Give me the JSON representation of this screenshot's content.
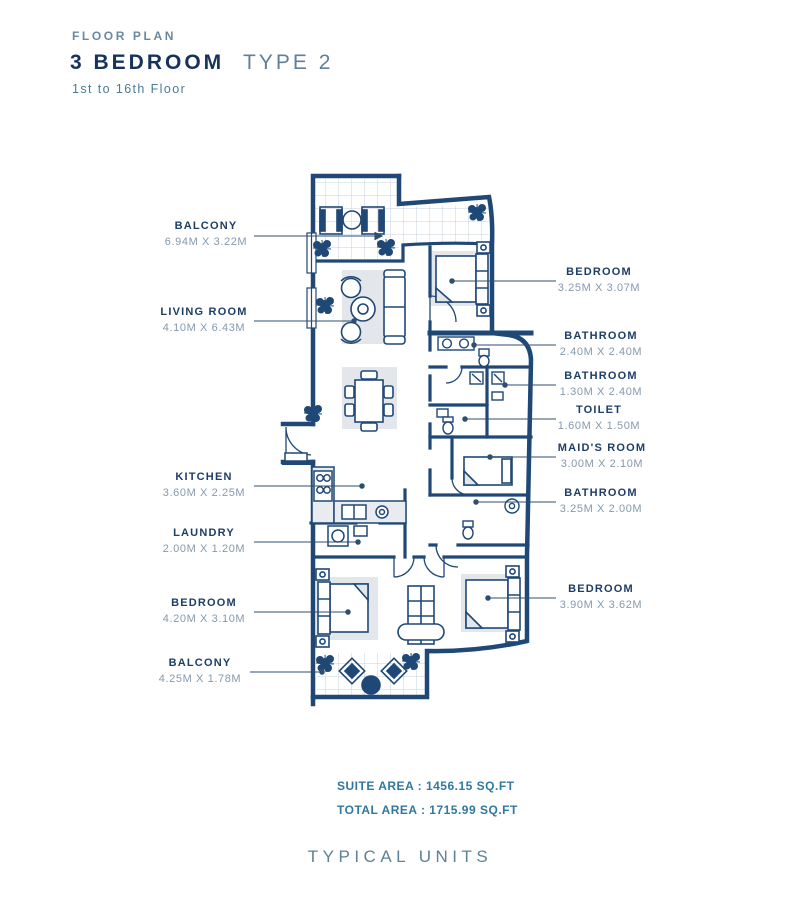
{
  "header": {
    "eyebrow": "FLOOR PLAN",
    "title_primary": "3 BEDROOM",
    "title_secondary": "TYPE 2",
    "subtitle": "1st to 16th Floor"
  },
  "room_labels": {
    "left": [
      {
        "name": "BALCONY",
        "dims": "6.94M X 3.22M"
      },
      {
        "name": "LIVING ROOM",
        "dims": "4.10M X 6.43M"
      },
      {
        "name": "KITCHEN",
        "dims": "3.60M X 2.25M"
      },
      {
        "name": "LAUNDRY",
        "dims": "2.00M X 1.20M"
      },
      {
        "name": "BEDROOM",
        "dims": "4.20M X 3.10M"
      },
      {
        "name": "BALCONY",
        "dims": "4.25M X 1.78M"
      }
    ],
    "right": [
      {
        "name": "BEDROOM",
        "dims": "3.25M X 3.07M"
      },
      {
        "name": "BATHROOM",
        "dims": "2.40M X 2.40M"
      },
      {
        "name": "BATHROOM",
        "dims": "1.30M X 2.40M"
      },
      {
        "name": "TOILET",
        "dims": "1.60M X 1.50M"
      },
      {
        "name": "MAID'S ROOM",
        "dims": "3.00M X 2.10M"
      },
      {
        "name": "BATHROOM",
        "dims": "3.25M X 2.00M"
      },
      {
        "name": "BEDROOM",
        "dims": "3.90M X 3.62M"
      }
    ]
  },
  "areas": {
    "suite_area": "SUITE AREA : 1456.15 SQ.FT",
    "total_area": "TOTAL AREA : 1715.99 SQ.FT"
  },
  "footer": {
    "caption": "TYPICAL UNITS"
  },
  "colors": {
    "wall_navy": "#1f4876",
    "title_navy": "#17335c",
    "muted_blue": "#5f7f9c",
    "teal_text": "#30789f",
    "label_navy": "#1d3e66",
    "dims_gray_blue": "#8599ad",
    "rug_gray": "#e3e7ec",
    "tile_line": "#c6d2de"
  }
}
